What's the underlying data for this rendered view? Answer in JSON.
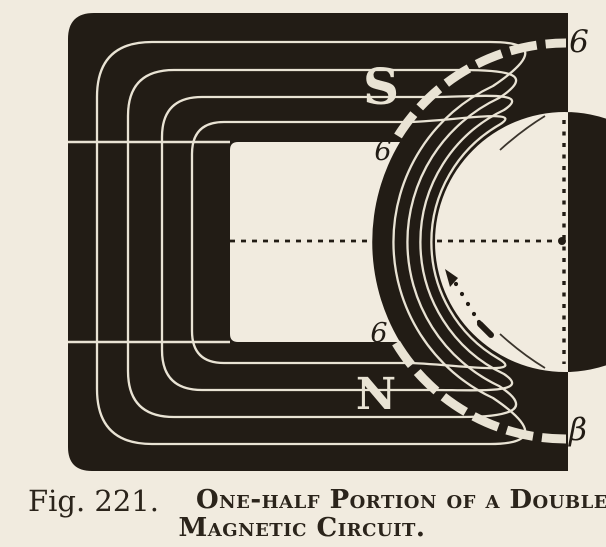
{
  "figure": {
    "pole_labels": {
      "top": "S",
      "bottom": "N"
    },
    "point_labels": {
      "gap_top": "6",
      "gap_bottom": "6",
      "edge_top_right": "6",
      "edge_bottom_right": "β"
    },
    "caption": {
      "fig_no": "Fig. 221.",
      "line1": "One-half Portion of a Double",
      "line2": "Magnetic Circuit."
    },
    "colors": {
      "paper": "#f1ebdf",
      "ink": "#221c15",
      "flux_line": "#e9e3d4",
      "caption_ink": "#2b241b"
    }
  }
}
